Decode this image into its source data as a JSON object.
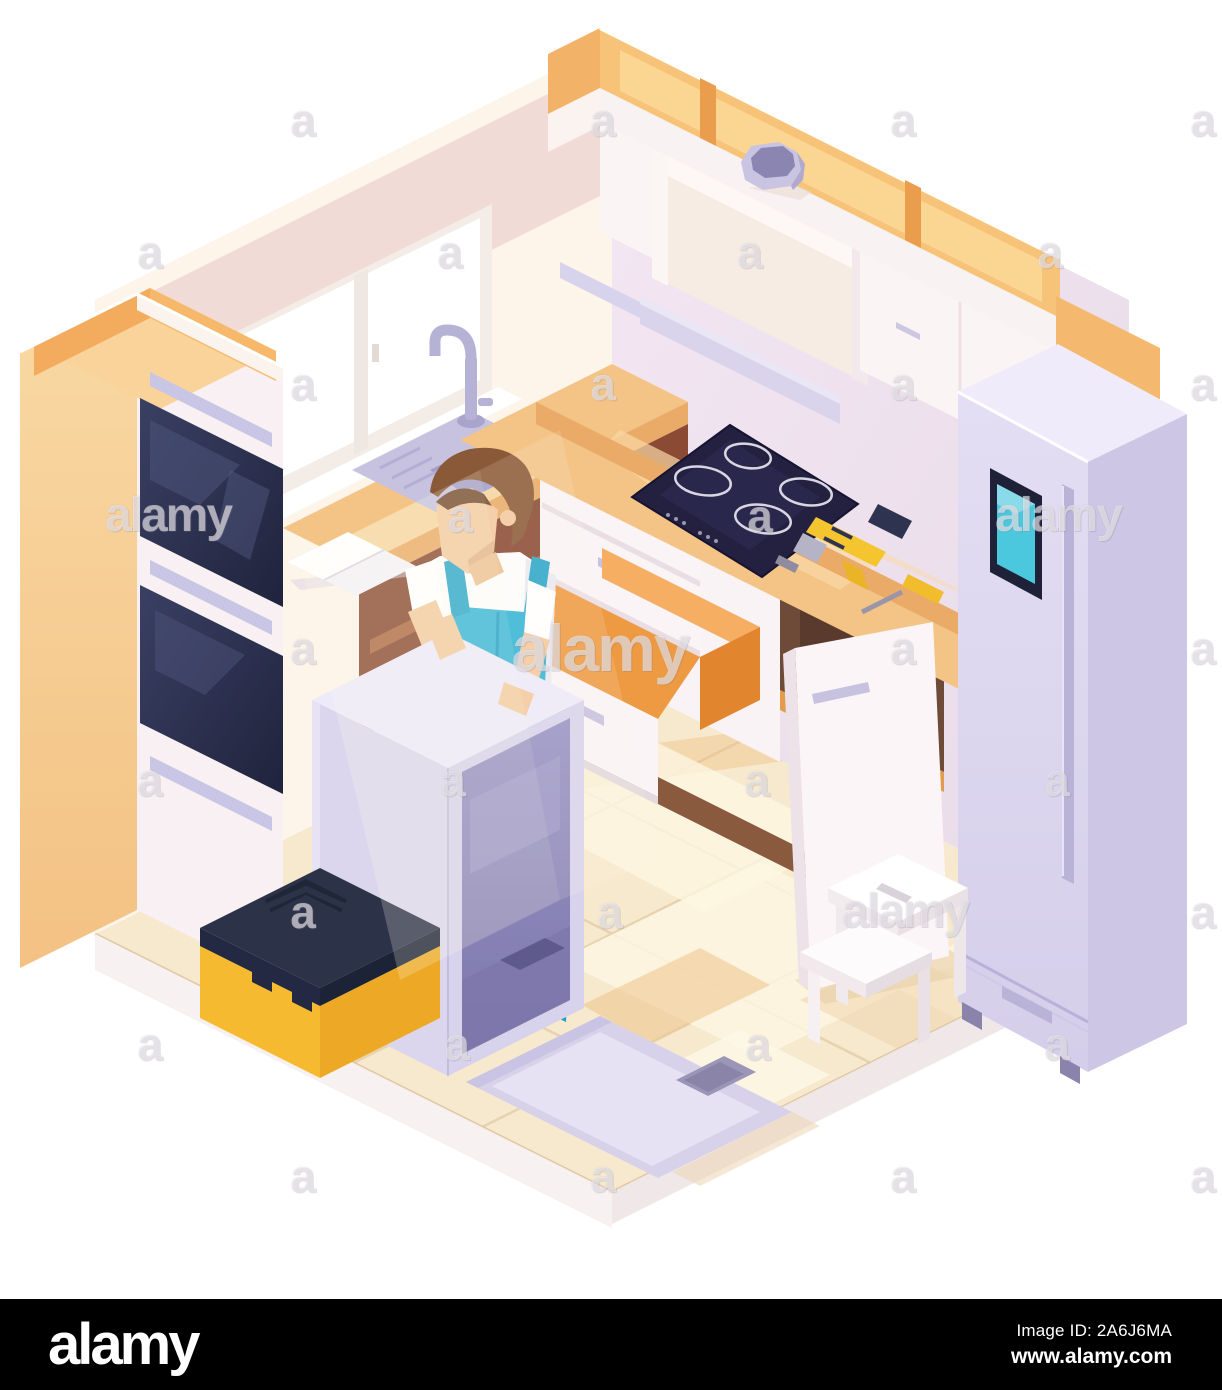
{
  "image": {
    "kind": "stock-illustration-preview",
    "subject": "Isometric kitchen with technician installing a dishwasher"
  },
  "palette": {
    "bar_bg": "#000000",
    "bar_text": "#ffffff",
    "watermark_color": "rgba(255,255,255,0.52)",
    "floor": "#f7e9ce",
    "wood_counter": "#f3c486",
    "cabinet_white": "#faf4f5",
    "orange_top": "#f7c379",
    "overalls_teal": "#35b5d7",
    "fridge_lavender": "#d8d2ec",
    "oven_glass": "#2b2f4c",
    "toolbox_yellow": "#f6ba30",
    "toolbox_lid": "#2c3349",
    "screen_teal": "#4cc8de",
    "drawer_orange": "#ee9a42"
  },
  "watermark": {
    "letter": "a",
    "word": "alamy",
    "rows": [
      {
        "y": 120,
        "items": [
          {
            "x": 303,
            "t": "a"
          },
          {
            "x": 603,
            "t": "a"
          },
          {
            "x": 903,
            "t": "a"
          },
          {
            "x": 1203,
            "t": "a"
          }
        ]
      },
      {
        "y": 252,
        "items": [
          {
            "x": 150,
            "t": "a"
          },
          {
            "x": 450,
            "t": "a"
          },
          {
            "x": 750,
            "t": "a"
          },
          {
            "x": 1050,
            "t": "a"
          }
        ]
      },
      {
        "y": 384,
        "items": [
          {
            "x": 303,
            "t": "a"
          },
          {
            "x": 603,
            "t": "a"
          },
          {
            "x": 903,
            "t": "a"
          },
          {
            "x": 1203,
            "t": "a"
          }
        ]
      },
      {
        "y": 516,
        "items": [
          {
            "x": 168,
            "t": "word"
          },
          {
            "x": 460,
            "t": "a"
          },
          {
            "x": 760,
            "t": "a"
          },
          {
            "x": 1058,
            "t": "word"
          }
        ]
      },
      {
        "y": 648,
        "items": [
          {
            "x": 303,
            "t": "a"
          },
          {
            "x": 600,
            "t": "word-big"
          },
          {
            "x": 903,
            "t": "a"
          },
          {
            "x": 1203,
            "t": "a"
          }
        ]
      },
      {
        "y": 780,
        "items": [
          {
            "x": 150,
            "t": "a"
          },
          {
            "x": 453,
            "t": "a"
          },
          {
            "x": 757,
            "t": "a"
          },
          {
            "x": 1057,
            "t": "a"
          }
        ]
      },
      {
        "y": 912,
        "items": [
          {
            "x": 303,
            "t": "a"
          },
          {
            "x": 610,
            "t": "a"
          },
          {
            "x": 905,
            "t": "word"
          },
          {
            "x": 1203,
            "t": "a"
          }
        ]
      },
      {
        "y": 1044,
        "items": [
          {
            "x": 150,
            "t": "a"
          },
          {
            "x": 457,
            "t": "a"
          },
          {
            "x": 758,
            "t": "a"
          },
          {
            "x": 1057,
            "t": "a"
          }
        ]
      },
      {
        "y": 1176,
        "items": [
          {
            "x": 303,
            "t": "a"
          },
          {
            "x": 603,
            "t": "a"
          },
          {
            "x": 903,
            "t": "a"
          },
          {
            "x": 1203,
            "t": "a"
          }
        ]
      }
    ]
  },
  "footer": {
    "logo": "alamy",
    "image_id": "Image ID: 2A6J6MA",
    "url": "www.alamy.com"
  }
}
